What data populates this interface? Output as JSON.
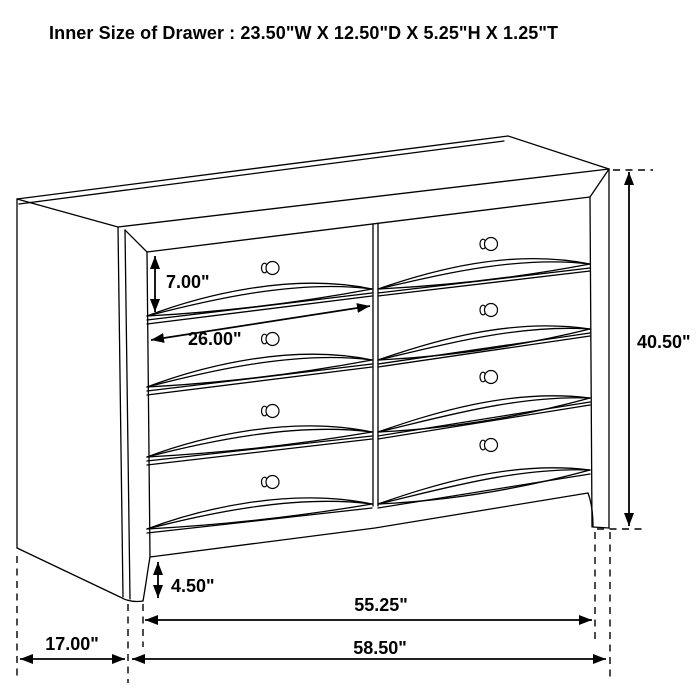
{
  "title": "Inner Size of Drawer : 23.50\"W X 12.50\"D X 5.25\"H X 1.25\"T",
  "dimensions": {
    "drawer_height": "7.00\"",
    "drawer_width": "26.00\"",
    "total_height": "40.50\"",
    "foot_height": "4.50\"",
    "front_width": "55.25\"",
    "side_depth": "17.00\"",
    "total_width": "58.50\""
  },
  "colors": {
    "line": "#000000",
    "background": "#ffffff"
  }
}
